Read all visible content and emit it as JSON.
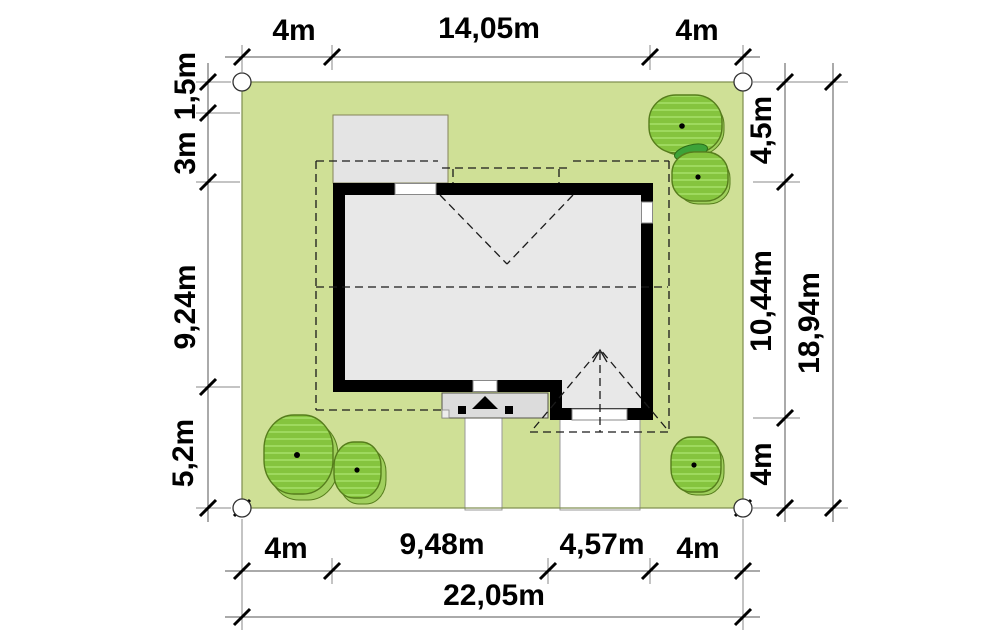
{
  "plan": {
    "kind": "house site plan",
    "colors": {
      "plot_green": "#cfe096",
      "tree_green": "#85c43e",
      "tree_outline": "#567d1c",
      "bush_dark_green": "#3da339",
      "wall_black": "#000000",
      "interior_gray": "#e8e8e8",
      "terrace_gray": "#e4e4e4"
    },
    "dimensions": {
      "top": {
        "left_setback": "4m",
        "house_width": "14,05m",
        "right_setback": "4m"
      },
      "left": {
        "terrace_offset": "1,5m",
        "front_setback": "3m",
        "house_depth": "9,24m",
        "rear_setback": "5,2m"
      },
      "right": {
        "front_setback": "4,5m",
        "house_depth": "10,44m",
        "rear_setback": "4m",
        "total_depth": "18,94m"
      },
      "bottom": {
        "left_setback": "4m",
        "house_width": "9,48m",
        "garage_width": "4,57m",
        "right_setback": "4m",
        "total_width": "22,05m"
      }
    }
  }
}
